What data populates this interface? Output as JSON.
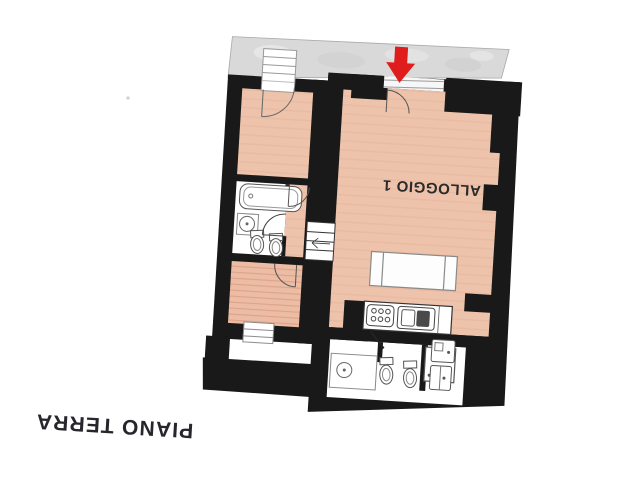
{
  "plan": {
    "floor_label": "PIANO TERRA",
    "unit_label": "ALLOGGIO 1",
    "orientation": "plan shown rotated 180 degrees (labels upside down)",
    "colors": {
      "wall": "#191919",
      "floor_salmon": "#eec3ab",
      "floor_wood_stripe": "#d89a80",
      "terrace_gray": "#d9d9d9",
      "entrance_arrow_red": "#e01d1d",
      "fixture_stroke": "#555555",
      "background": "#ffffff"
    },
    "icons": [
      {
        "name": "entrance-arrow-icon",
        "meaning": "red arrow pointing at main entrance door"
      }
    ],
    "symbols": [
      "terrace-strip",
      "entrance-door-swing",
      "french-window-steps",
      "bathtub",
      "washbasin",
      "toilet",
      "bidet",
      "shower-box",
      "kitchen-hob",
      "kitchen-sink",
      "kitchen-counter",
      "table",
      "internal-stairs",
      "appliance",
      "door-swing",
      "window"
    ]
  }
}
